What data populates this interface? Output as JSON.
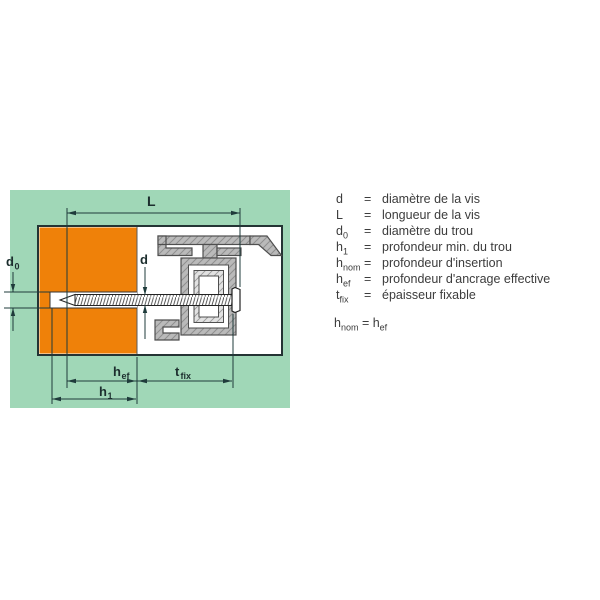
{
  "diagram": {
    "labels": {
      "L": "L",
      "d": "d",
      "d0_base": "d",
      "d0_sub": "0",
      "hef_base": "h",
      "hef_sub": "ef",
      "h1_base": "h",
      "h1_sub": "1",
      "tfix_base": "t",
      "tfix_sub": "fix"
    },
    "colors": {
      "panel_green": "#a0d7b7",
      "wall_orange": "#ef8109",
      "profile_gray": "#bababa",
      "line_dark": "#1f3b3b"
    }
  },
  "legend": {
    "rows": [
      {
        "base": "d",
        "sub": "",
        "eq": "=",
        "desc": "diamètre de la vis"
      },
      {
        "base": "L",
        "sub": "",
        "eq": "=",
        "desc": "longueur de la vis"
      },
      {
        "base": "d",
        "sub": "0",
        "eq": "=",
        "desc": "diamètre du trou"
      },
      {
        "base": "h",
        "sub": "1",
        "eq": "=",
        "desc": "profondeur min. du trou"
      },
      {
        "base": "h",
        "sub": "nom",
        "eq": "=",
        "desc": "profondeur d'insertion"
      },
      {
        "base": "h",
        "sub": "ef",
        "eq": "=",
        "desc": "profondeur d'ancrage effective"
      },
      {
        "base": "t",
        "sub": "fix",
        "eq": "=",
        "desc": "épaisseur fixable"
      }
    ],
    "note": {
      "lhs_base": "h",
      "lhs_sub": "nom",
      "eq": " = ",
      "rhs_base": "h",
      "rhs_sub": "ef"
    }
  }
}
